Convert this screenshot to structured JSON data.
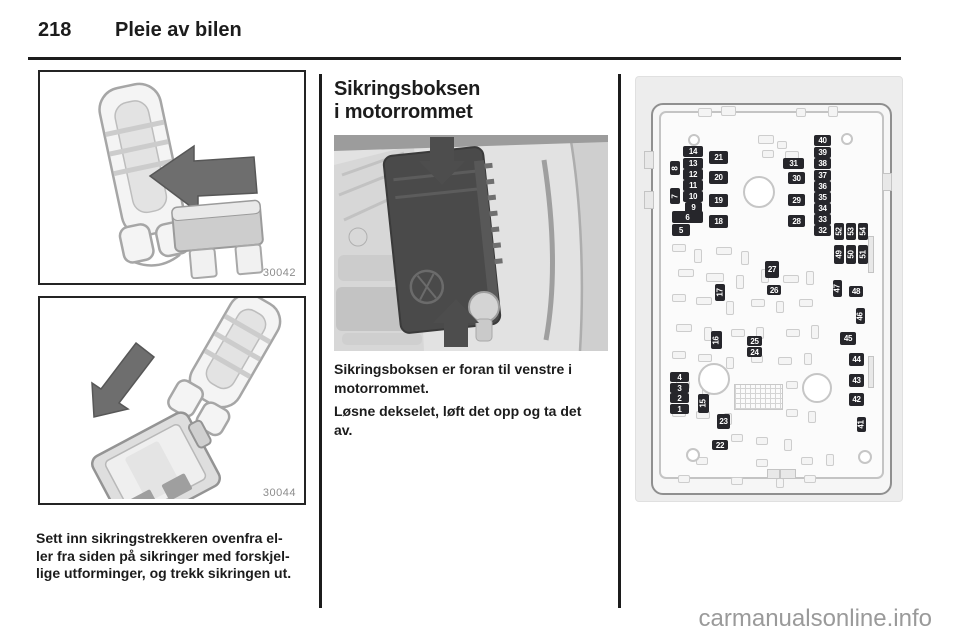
{
  "header": {
    "page_number": "218",
    "chapter_title": "Pleie av bilen"
  },
  "left_column": {
    "figure1_id": "30042",
    "figure2_id": "30044",
    "caption_lines": [
      "Sett inn sikringstrekkeren ovenfra el-",
      "ler fra siden på sikringer med forskjel-",
      "lige utforminger, og trekk sikringen ut."
    ]
  },
  "middle_column": {
    "heading_lines": [
      "Sikringsboksen",
      "i motorrommet"
    ],
    "paragraph1": "Sikringsboksen er foran til venstre i motorrommet.",
    "paragraph2": "Løsne dekselet, løft det opp og ta det av."
  },
  "fuse_diagram": {
    "description": "Engine compartment fuse box layout diagram",
    "panel_color": "#ededed",
    "fuse_color": "#26262b",
    "number_color": "#ffffff",
    "fuses": [
      {
        "n": "14",
        "x": 47,
        "y": 69,
        "w": 20,
        "h": 11
      },
      {
        "n": "13",
        "x": 47,
        "y": 81,
        "w": 20,
        "h": 11
      },
      {
        "n": "12",
        "x": 47,
        "y": 92,
        "w": 20,
        "h": 11
      },
      {
        "n": "11",
        "x": 47,
        "y": 103,
        "w": 20,
        "h": 11
      },
      {
        "n": "10",
        "x": 47,
        "y": 114,
        "w": 20,
        "h": 11
      },
      {
        "n": "9",
        "x": 49,
        "y": 125,
        "w": 17,
        "h": 11
      },
      {
        "n": "6",
        "x": 36,
        "y": 134,
        "w": 31,
        "h": 12
      },
      {
        "n": "5",
        "x": 36,
        "y": 147,
        "w": 18,
        "h": 12
      },
      {
        "n": "8",
        "x": 34,
        "y": 84,
        "w": 10,
        "h": 14,
        "r": 1
      },
      {
        "n": "7",
        "x": 34,
        "y": 111,
        "w": 10,
        "h": 16,
        "r": 1
      },
      {
        "n": "21",
        "x": 73,
        "y": 74,
        "w": 19,
        "h": 13
      },
      {
        "n": "20",
        "x": 73,
        "y": 94,
        "w": 19,
        "h": 13
      },
      {
        "n": "19",
        "x": 73,
        "y": 117,
        "w": 19,
        "h": 13
      },
      {
        "n": "18",
        "x": 73,
        "y": 138,
        "w": 19,
        "h": 13
      },
      {
        "n": "31",
        "x": 147,
        "y": 81,
        "w": 21,
        "h": 11
      },
      {
        "n": "30",
        "x": 152,
        "y": 95,
        "w": 17,
        "h": 12
      },
      {
        "n": "29",
        "x": 152,
        "y": 117,
        "w": 17,
        "h": 12
      },
      {
        "n": "28",
        "x": 152,
        "y": 138,
        "w": 17,
        "h": 12
      },
      {
        "n": "40",
        "x": 178,
        "y": 58,
        "w": 17,
        "h": 11
      },
      {
        "n": "39",
        "x": 178,
        "y": 70,
        "w": 17,
        "h": 11
      },
      {
        "n": "38",
        "x": 178,
        "y": 81,
        "w": 17,
        "h": 11
      },
      {
        "n": "37",
        "x": 178,
        "y": 93,
        "w": 17,
        "h": 11
      },
      {
        "n": "36",
        "x": 178,
        "y": 104,
        "w": 17,
        "h": 11
      },
      {
        "n": "35",
        "x": 178,
        "y": 115,
        "w": 17,
        "h": 11
      },
      {
        "n": "34",
        "x": 178,
        "y": 126,
        "w": 17,
        "h": 11
      },
      {
        "n": "33",
        "x": 178,
        "y": 137,
        "w": 17,
        "h": 11
      },
      {
        "n": "32",
        "x": 178,
        "y": 148,
        "w": 17,
        "h": 11
      },
      {
        "n": "52",
        "x": 198,
        "y": 146,
        "w": 10,
        "h": 17,
        "r": 1
      },
      {
        "n": "53",
        "x": 210,
        "y": 146,
        "w": 10,
        "h": 17,
        "r": 1
      },
      {
        "n": "54",
        "x": 222,
        "y": 146,
        "w": 10,
        "h": 17,
        "r": 1
      },
      {
        "n": "49",
        "x": 198,
        "y": 168,
        "w": 10,
        "h": 19,
        "r": 1
      },
      {
        "n": "50",
        "x": 210,
        "y": 168,
        "w": 10,
        "h": 19,
        "r": 1
      },
      {
        "n": "51",
        "x": 222,
        "y": 168,
        "w": 10,
        "h": 19,
        "r": 1
      },
      {
        "n": "27",
        "x": 129,
        "y": 184,
        "w": 14,
        "h": 17
      },
      {
        "n": "26",
        "x": 131,
        "y": 208,
        "w": 14,
        "h": 10
      },
      {
        "n": "17",
        "x": 79,
        "y": 207,
        "w": 10,
        "h": 17,
        "r": 1
      },
      {
        "n": "16",
        "x": 75,
        "y": 254,
        "w": 11,
        "h": 18,
        "r": 1
      },
      {
        "n": "25",
        "x": 111,
        "y": 259,
        "w": 15,
        "h": 10
      },
      {
        "n": "24",
        "x": 111,
        "y": 270,
        "w": 15,
        "h": 10
      },
      {
        "n": "15",
        "x": 62,
        "y": 317,
        "w": 11,
        "h": 19,
        "r": 1
      },
      {
        "n": "23",
        "x": 81,
        "y": 337,
        "w": 13,
        "h": 15
      },
      {
        "n": "22",
        "x": 76,
        "y": 363,
        "w": 16,
        "h": 10
      },
      {
        "n": "4",
        "x": 34,
        "y": 295,
        "w": 19,
        "h": 10
      },
      {
        "n": "3",
        "x": 34,
        "y": 306,
        "w": 19,
        "h": 10
      },
      {
        "n": "2",
        "x": 34,
        "y": 316,
        "w": 19,
        "h": 10
      },
      {
        "n": "1",
        "x": 34,
        "y": 327,
        "w": 19,
        "h": 10
      },
      {
        "n": "47",
        "x": 197,
        "y": 203,
        "w": 9,
        "h": 17,
        "r": 1
      },
      {
        "n": "48",
        "x": 213,
        "y": 209,
        "w": 14,
        "h": 11
      },
      {
        "n": "46",
        "x": 220,
        "y": 231,
        "w": 9,
        "h": 16,
        "r": 1
      },
      {
        "n": "45",
        "x": 204,
        "y": 255,
        "w": 16,
        "h": 13
      },
      {
        "n": "44",
        "x": 213,
        "y": 276,
        "w": 15,
        "h": 13
      },
      {
        "n": "43",
        "x": 213,
        "y": 297,
        "w": 15,
        "h": 13
      },
      {
        "n": "42",
        "x": 213,
        "y": 316,
        "w": 15,
        "h": 13
      },
      {
        "n": "41",
        "x": 221,
        "y": 340,
        "w": 9,
        "h": 15,
        "r": 1
      }
    ],
    "slots": [
      [
        62,
        31,
        12,
        7
      ],
      [
        85,
        29,
        13,
        8
      ],
      [
        160,
        31,
        8,
        7
      ],
      [
        192,
        29,
        8,
        9
      ],
      [
        122,
        58,
        14,
        7
      ],
      [
        141,
        64,
        8,
        6
      ],
      [
        126,
        73,
        10,
        6
      ],
      [
        149,
        74,
        12,
        7
      ],
      [
        36,
        167,
        12,
        6
      ],
      [
        58,
        172,
        6,
        12
      ],
      [
        80,
        170,
        14,
        6
      ],
      [
        105,
        174,
        6,
        12
      ],
      [
        42,
        192,
        14,
        6
      ],
      [
        70,
        196,
        16,
        7
      ],
      [
        100,
        198,
        6,
        12
      ],
      [
        125,
        192,
        6,
        12
      ],
      [
        147,
        198,
        14,
        6
      ],
      [
        170,
        194,
        6,
        12
      ],
      [
        36,
        217,
        12,
        6
      ],
      [
        60,
        220,
        14,
        6
      ],
      [
        90,
        224,
        6,
        12
      ],
      [
        115,
        222,
        12,
        6
      ],
      [
        140,
        224,
        6,
        10
      ],
      [
        163,
        222,
        12,
        6
      ],
      [
        40,
        247,
        14,
        6
      ],
      [
        68,
        250,
        6,
        12
      ],
      [
        95,
        252,
        12,
        6
      ],
      [
        120,
        250,
        6,
        10
      ],
      [
        150,
        252,
        12,
        6
      ],
      [
        175,
        248,
        6,
        12
      ],
      [
        36,
        274,
        12,
        6
      ],
      [
        62,
        277,
        12,
        6
      ],
      [
        90,
        280,
        6,
        10
      ],
      [
        115,
        278,
        10,
        6
      ],
      [
        142,
        280,
        12,
        6
      ],
      [
        168,
        276,
        6,
        10
      ],
      [
        40,
        304,
        12,
        6
      ],
      [
        66,
        307,
        6,
        10
      ],
      [
        150,
        304,
        10,
        6
      ],
      [
        175,
        302,
        6,
        10
      ],
      [
        36,
        332,
        12,
        6
      ],
      [
        60,
        334,
        12,
        6
      ],
      [
        88,
        336,
        6,
        10
      ],
      [
        150,
        332,
        10,
        6
      ],
      [
        172,
        334,
        6,
        10
      ],
      [
        95,
        357,
        10,
        6
      ],
      [
        120,
        360,
        10,
        6
      ],
      [
        148,
        362,
        6,
        10
      ],
      [
        60,
        380,
        10,
        6
      ],
      [
        120,
        382,
        10,
        6
      ],
      [
        165,
        380,
        10,
        6
      ],
      [
        190,
        377,
        6,
        10
      ],
      [
        42,
        398,
        10,
        6
      ],
      [
        95,
        400,
        10,
        6
      ],
      [
        140,
        401,
        6,
        8
      ],
      [
        168,
        398,
        10,
        6
      ]
    ],
    "circles": [
      [
        121,
        113,
        14
      ],
      [
        56,
        61,
        4
      ],
      [
        209,
        60,
        4
      ],
      [
        76,
        300,
        14
      ],
      [
        179,
        309,
        13
      ],
      [
        55,
        376,
        5
      ],
      [
        227,
        378,
        5
      ]
    ],
    "hatch": {
      "x": 98,
      "y": 307,
      "w": 47,
      "h": 24
    },
    "bars": [
      [
        232,
        159,
        4,
        35
      ],
      [
        232,
        279,
        4,
        30
      ],
      [
        8,
        74,
        8,
        16
      ],
      [
        8,
        114,
        8,
        16
      ],
      [
        246,
        96,
        8,
        16
      ],
      [
        131,
        392,
        11,
        8
      ],
      [
        144,
        392,
        14,
        8
      ]
    ]
  },
  "watermark": "carmanualsonline.info"
}
